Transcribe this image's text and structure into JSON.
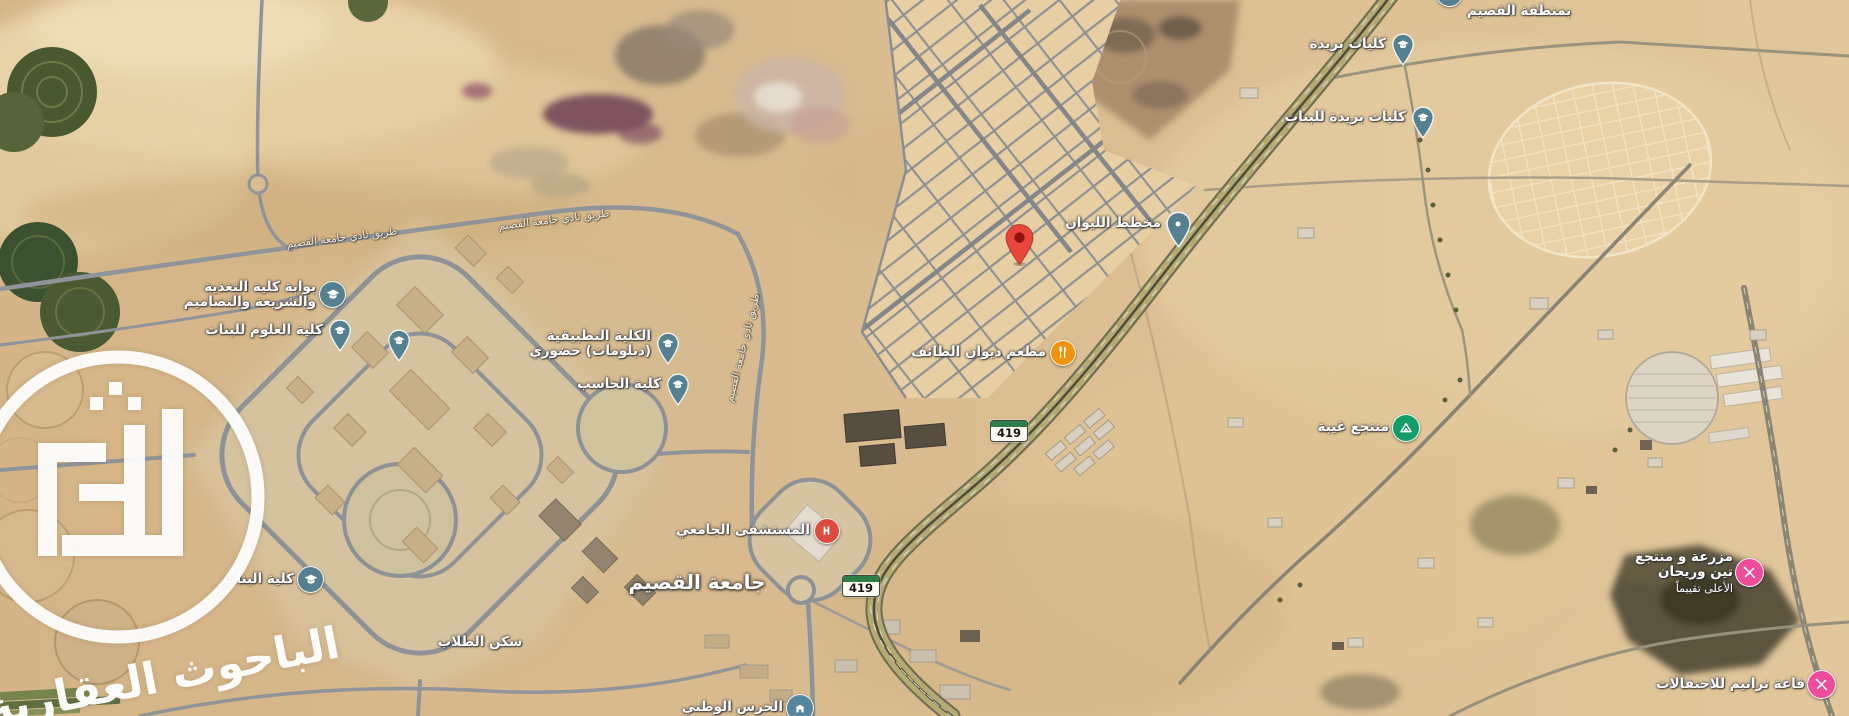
{
  "map": {
    "watermark": {
      "text": "الباحوث العقارية"
    },
    "colors": {
      "marker_school": "#54808f",
      "marker_place_pin": "#54808f",
      "marker_red_pin": "#e8453c",
      "marker_red_pin_dot": "#8c1410",
      "marker_restaurant": "#f0930f",
      "marker_hospital": "#dd4b3e",
      "marker_resort": "#129d68",
      "marker_attraction": "#ee4d9b",
      "marker_government": "#5486a0",
      "shield_green": "#2d7d46"
    },
    "route_shields": [
      {
        "label": "419",
        "x": 1008,
        "y": 430
      },
      {
        "label": "419",
        "x": 860,
        "y": 585
      }
    ],
    "road_labels": [
      {
        "text": "طريق ثادي جامعة القصيم",
        "x": 342,
        "y": 238,
        "angle": -7
      },
      {
        "text": "طريق ثادي جامعة القصيم",
        "x": 554,
        "y": 220,
        "angle": -7
      },
      {
        "text": "طريق ثادي جامعة القصيم",
        "x": 743,
        "y": 348,
        "angle": -76
      }
    ],
    "area_labels": [
      {
        "text": "جامعة القصيم",
        "x": 697,
        "y": 582
      }
    ],
    "pois": [
      {
        "id": "gate-college",
        "lines": [
          "بوابة كلية التغذية",
          "والشريعة والتصاميم"
        ],
        "x": 333,
        "y": 295,
        "kind": "school-circle",
        "side": "left"
      },
      {
        "id": "science-girls",
        "lines": [
          "كلية العلوم للبنات"
        ],
        "x": 340,
        "y": 331,
        "kind": "school-pin",
        "side": "left"
      },
      {
        "id": "campus-college-3",
        "lines": [],
        "x": 399,
        "y": 341,
        "kind": "school-pin",
        "side": "left"
      },
      {
        "id": "applied-college",
        "lines": [
          "الكلية التطبيقية",
          "(دبلومات) حضوري"
        ],
        "x": 668,
        "y": 344,
        "kind": "school-pin",
        "side": "left"
      },
      {
        "id": "computer-college",
        "lines": [
          "كلية الحاسب"
        ],
        "x": 678,
        "y": 385,
        "kind": "school-pin",
        "side": "left"
      },
      {
        "id": "girls-college",
        "lines": [
          "كلية البنات"
        ],
        "x": 311,
        "y": 580,
        "kind": "school-circle",
        "side": "left"
      },
      {
        "id": "buraydah-colleges",
        "lines": [
          "كليات بريدة"
        ],
        "x": 1403,
        "y": 45,
        "kind": "school-pin",
        "side": "left"
      },
      {
        "id": "buraydah-girls",
        "lines": [
          "كليات بريدة للبنات"
        ],
        "x": 1423,
        "y": 118,
        "kind": "school-pin",
        "side": "left"
      },
      {
        "id": "qassim-region",
        "lines": [
          "بمنطقة القصيم"
        ],
        "x": 1450,
        "y": -6,
        "kind": "school-circle",
        "side": "right",
        "dy": 18
      },
      {
        "id": "dropped-pin",
        "lines": [],
        "x": 1019,
        "y": 237,
        "kind": "red-pin",
        "side": "left"
      },
      {
        "id": "liwan-plan",
        "lines": [
          "مخطط الليوان"
        ],
        "x": 1178,
        "y": 224,
        "kind": "place-pin",
        "side": "left"
      },
      {
        "id": "diwan-taif-restaurant",
        "lines": [
          "مطعم ديوان الطائف"
        ],
        "x": 1063,
        "y": 353,
        "kind": "restaurant",
        "side": "left"
      },
      {
        "id": "university-hospital",
        "lines": [
          "المستشفى الجامعي"
        ],
        "x": 827,
        "y": 531,
        "kind": "hospital",
        "side": "left"
      },
      {
        "id": "ghaybah-resort",
        "lines": [
          "منتجع غيبة"
        ],
        "x": 1406,
        "y": 428,
        "kind": "resort",
        "side": "left"
      },
      {
        "id": "teen-rayhan-farm",
        "lines": [
          "مزرعة و منتجع",
          "تين وريحان",
          "الأعلى تقييماً"
        ],
        "x": 1750,
        "y": 573,
        "kind": "attraction",
        "side": "left"
      },
      {
        "id": "taranim-hall",
        "lines": [
          "قاعة ترانيم للاحتفالات"
        ],
        "x": 1822,
        "y": 685,
        "kind": "attraction",
        "side": "left"
      },
      {
        "id": "national-guard",
        "lines": [
          "الحرس الوطني"
        ],
        "x": 800,
        "y": 708,
        "kind": "government",
        "side": "left"
      },
      {
        "id": "student-housing",
        "lines": [
          "سكن الطلاب"
        ],
        "x": 480,
        "y": 643,
        "kind": "label-only",
        "side": "center"
      }
    ]
  }
}
